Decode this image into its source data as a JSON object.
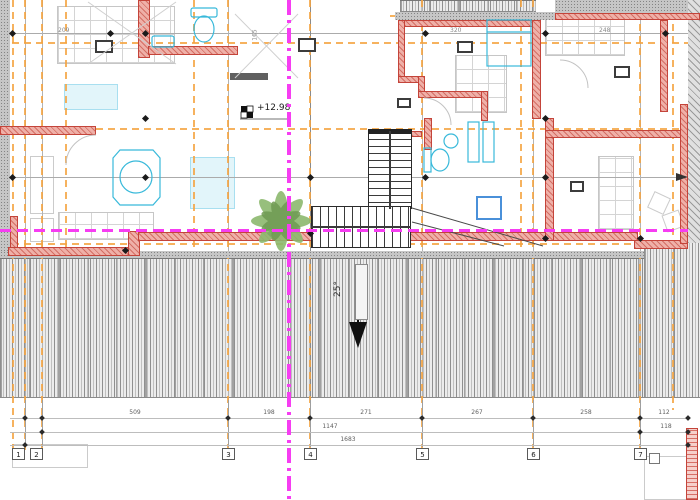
{
  "plan": {
    "elevation_label": "+12.98",
    "slope_label": "25°",
    "room_labels": [
      "209",
      "320",
      "248",
      "165"
    ],
    "grid_axes": [
      "1",
      "2",
      "3",
      "4",
      "5",
      "6",
      "7"
    ],
    "dims_row1": [
      "509",
      "198",
      "271",
      "267",
      "258",
      "112"
    ],
    "dims_row2": [
      "1147",
      "118"
    ],
    "dims_row3": [
      "1683"
    ],
    "colors": {
      "wall_line": "#c4443a",
      "wall_fill": "#efb0a8",
      "fixture_cyan": "#38b9da",
      "section_magenta": "#f63df2",
      "axis_orange": "#f4a442",
      "plant_green": "#7da95e",
      "hatch_gray": "#8f8f8f"
    }
  }
}
